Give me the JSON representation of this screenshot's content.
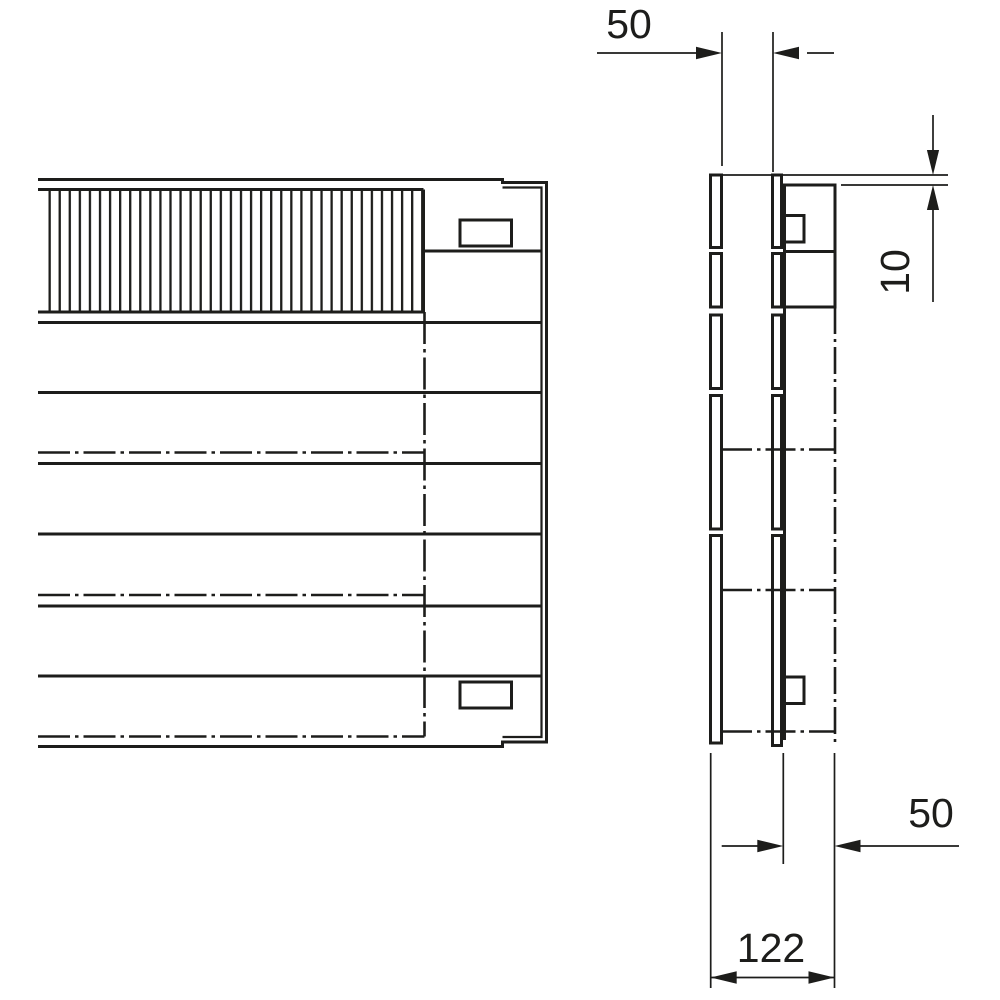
{
  "colors": {
    "line": "#1d1d1b",
    "background": "#ffffff"
  },
  "drawing": {
    "kind": "technical dimension drawing, two orthographic views",
    "dimensions": {
      "plate_spacing_top": {
        "value": "50"
      },
      "step_height": {
        "value": "10"
      },
      "body_depth": {
        "value": "50"
      },
      "overall_depth": {
        "value": "122"
      }
    }
  }
}
